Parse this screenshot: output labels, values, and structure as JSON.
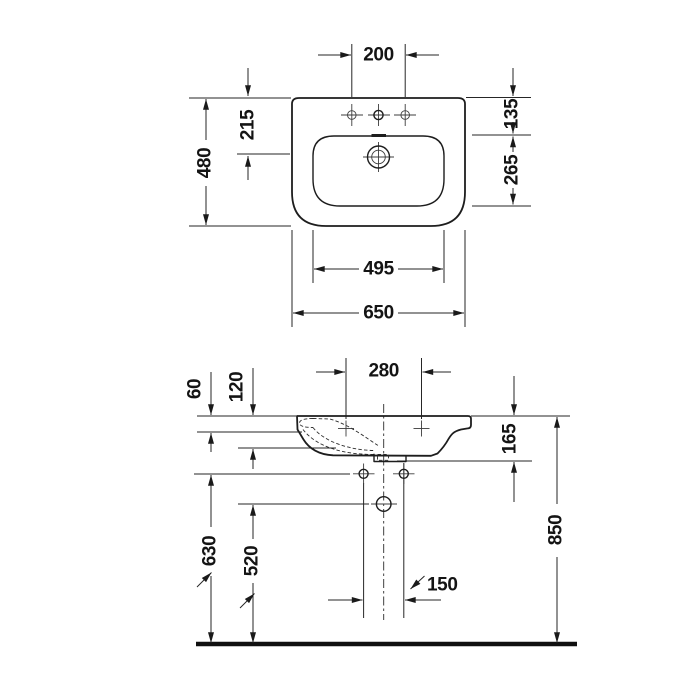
{
  "colors": {
    "line": "#1d1d1d",
    "background": "#ffffff"
  },
  "views": {
    "top": {
      "dims": {
        "tap_hole_spacing": "200",
        "rear_to_drain": "215",
        "overall_depth": "480",
        "rear_to_bowl_edge": "135",
        "bowl_front_back": "265",
        "bowl_width": "495",
        "overall_width": "650"
      }
    },
    "side": {
      "dims": {
        "fixing_hole_spacing": "280",
        "rim_to_front_apron": "60",
        "rim_to_bowl_bottom": "120",
        "rim_to_rear_underside": "165",
        "apron_underside_height": "630",
        "outlet_height": "520",
        "rim_height": "850",
        "outlet_hole_spacing": "150"
      }
    }
  }
}
